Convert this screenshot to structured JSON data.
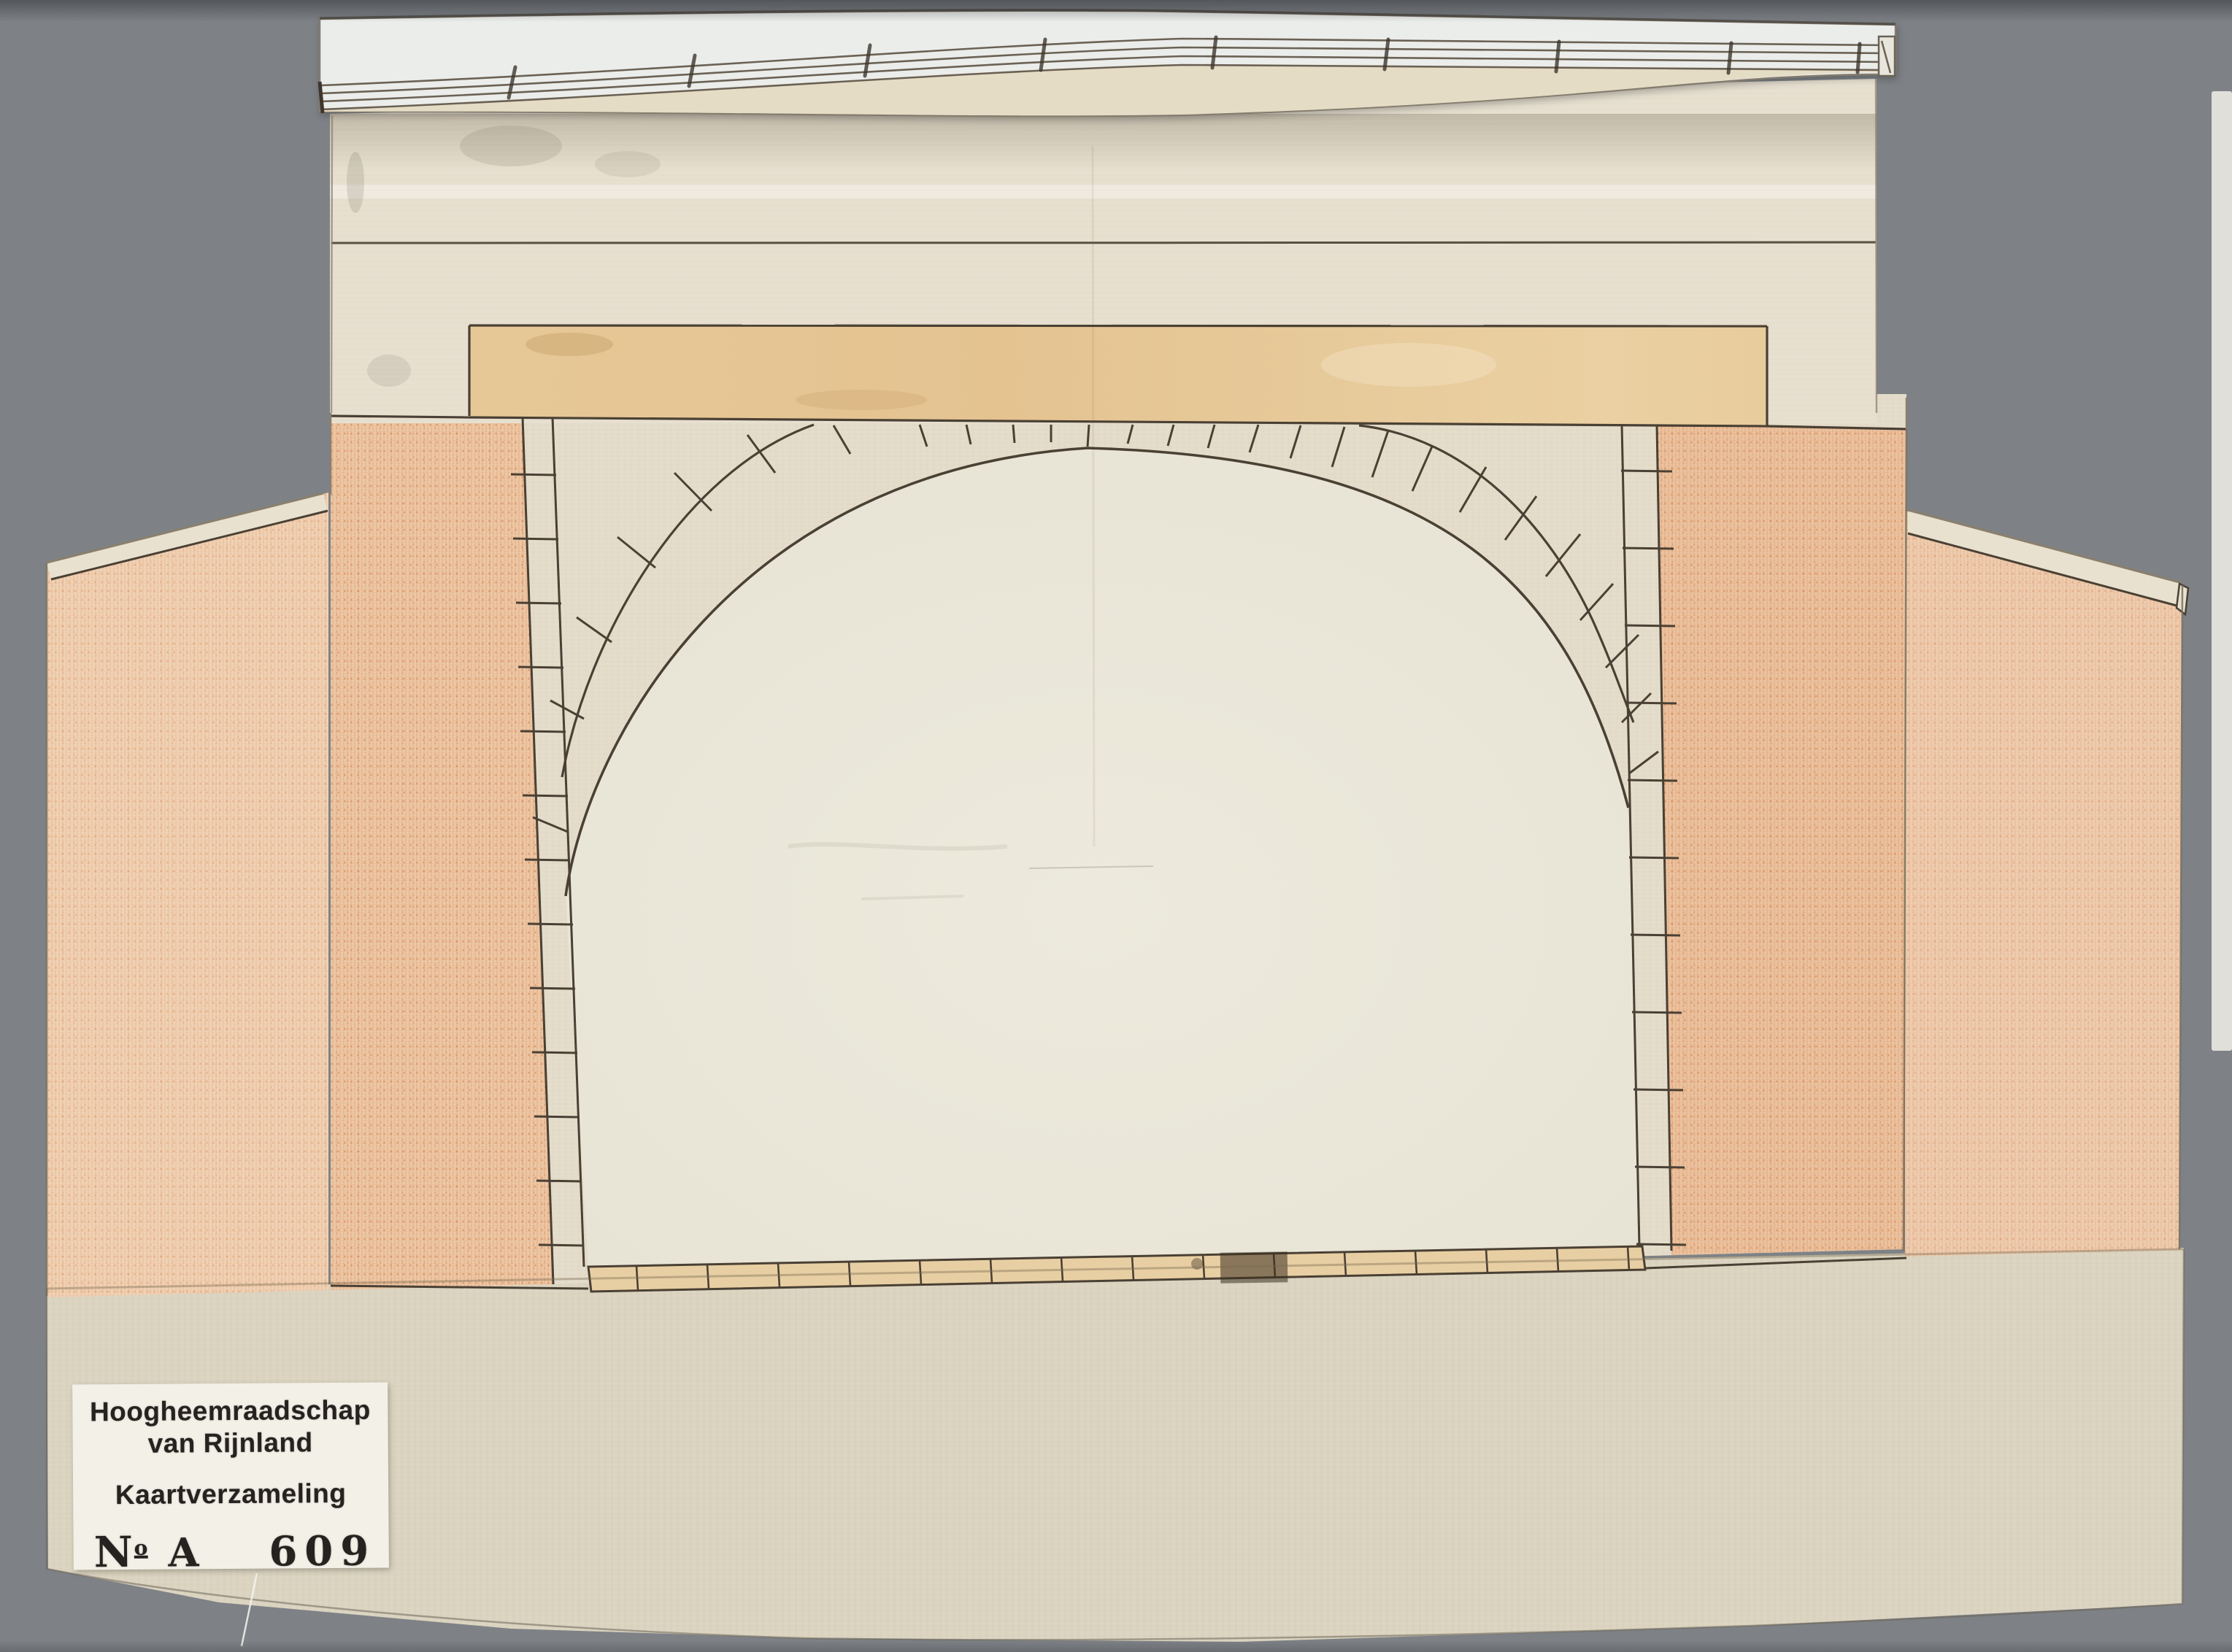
{
  "archive_label": {
    "organization_line1": "Hoogheemraadschap",
    "organization_line2": "van Rijnland",
    "collection": "Kaartverzameling",
    "number_prefix": "N",
    "number_prefix_ordinal": "o",
    "series_letter": "A",
    "item_number": "609"
  },
  "palette": {
    "background_gray": "#7e8286",
    "paper_cream": "#e5ddcb",
    "attic_cream": "#e7e0d0",
    "base_cream": "#dcd5c2",
    "opening_cream": "#ebe8da",
    "beam_tan": "#e5c593",
    "sill_tan": "#e8cfa3",
    "chalk_orange_pier": "#edc8a6",
    "chalk_orange_wing": "#f0d2b5",
    "coping_white": "#ebedeb",
    "ink_brown": "#4a4034",
    "label_white": "#f3f0e7",
    "label_text": "#262220"
  }
}
